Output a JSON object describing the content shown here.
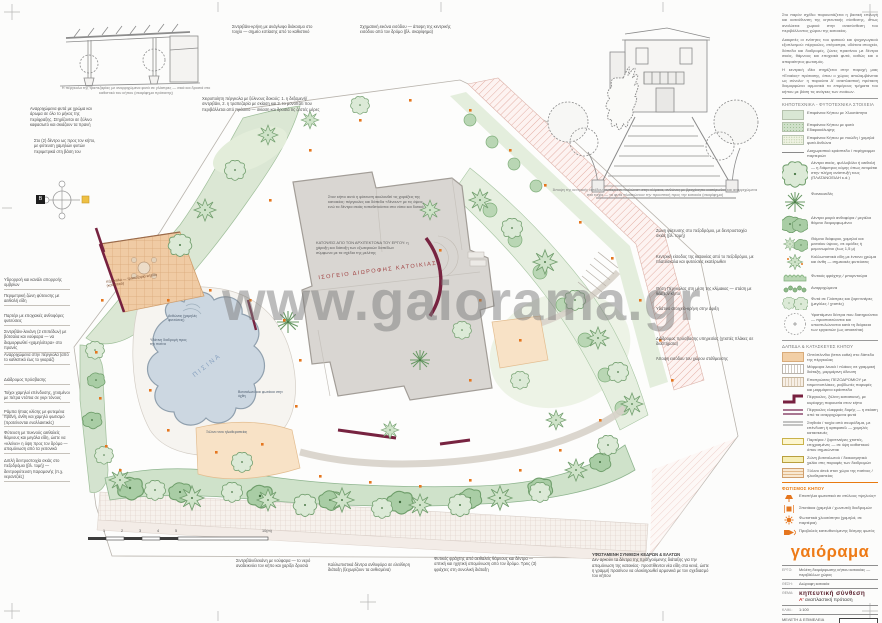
{
  "watermark": "www.gaiorama.gr",
  "compass": {
    "north": "Β"
  },
  "scalebar": {
    "ticks": [
      "1",
      "2",
      "3",
      "4",
      "5"
    ],
    "end_label": "10(m)"
  },
  "sketches": {
    "pergola_caption": "Η πέργκολα της τραπεζαρίας με αναρριχώμενα φυτά σε γλάστρες — σκιά και δροσιά στο καθιστικό του κήπου (σκαρίφημα πρότασης)",
    "house_caption": "Άποψη της κεντρικής εισόδου: κυπαρίσσι-«κολώνα» στην κλίμακα, ανθώνες με βραχόκηπο εκατέρωθεν και αναρριχώμενα στα τοιχία — τα φυτά πλαισιώνουν την προοπτική προς την κατοικία (σκαρίφημα)"
  },
  "plan": {
    "building_label": "ΙΣΟΓΕΙΟ ΔΙΩΡΟΦΗΣ ΚΑΤΟΙΚΙΑΣ",
    "pool_label": "ΠΙΣΙΝΑ",
    "pergola_label": "πέργκολα — τραπεζαρία κήπου (καθιστικό)",
    "note_design": "Στον κήπο αυτό η φύτευση ακολουθεί τις χαράξεις της κατοικίας: πέργκολες και δάπεδα «δένουν» με τις όψεις, ενώ τα δέντρα σκιάς τοποθετούνται στα νότια και δυτικά",
    "note_architect": "ΚΑΤΟΨΕΙΣ ΑΠΟ ΤΟΝ ΑΡΧΙΤΕΚΤΟΝΑ ΤΟΥ ΕΡΓΟΥ: η χάραξη και διάταξη των εξωτερικών δαπέδων σύμφωνα με τα σχέδια της μελέτης",
    "pool_notes": [
      "Ανθώνας (χαμηλές φυτεύσεις)",
      "Υδάτινη διαδρομή προς την πισίνα",
      "Βοτσαλωτό και φωτάκια στην όχθη",
      "Ξύλινο ντεκ ηλιοθεραπείας"
    ]
  },
  "annotations": {
    "left": [
      "Αναρριχώμενα φυτά με χρώμα και άρωμα σε όλο το μήκος της περίφραξης. Στηρίζονται σε ξύλινο καφασωτό και σκιάζουν τα πρανή",
      "Στο (2) δέντρο ως προς τον κήπο, με φύτευση χαμηλών φυτών περιμετρικά στη βάση του",
      "Υδρορροή και κανάλι απορροής ομβρίων",
      "Περιμετρική ζώνη φύτευσης με αειθαλή είδη",
      "Παρτέρι με εποχιακές ανθοφόρες φυτεύσεις",
      "Σιντριβάνι-λεκάνη (2 επιπέδων) με βότσαλα και νούφαρα — να διαμορφωθεί «χαμηλότερα» στο πρανές",
      "Αναρριχώμενα στην πέργκολα (από το καθιστικό έως το γκαράζ)",
      "Διάδρομος πρόσβασης",
      "Τοίχοι χαμηλοί επένδυσης, χτισμένοι με πέτρα ντόπια σε γκρι τόνους",
      "Ράμπα ήπιας κλίσης με φυτεμένα πρανή, άνθη και χαμηλό φωτισμό (προτείνονται εναλλακτικές)",
      "Φύτευση με πυκνούς αειθαλείς θάμνους και μεγάλα είδη, ώστε να «κλείνει» η όψη προς τον δρόμο — απομόνωση από τα γειτονικά",
      "Διπλή δεντροστοιχία σκιάς στο πεζοδρόμιο (βλ. τομή) — δεντροφύτευση παραμονής (π.χ. νεραντζιές)"
    ],
    "top": [
      "Σιντριβάνι-κρήνη με ανάγλυφο διάκοσμο στο τοιχίο — σημείο εστίασης από το καθιστικό",
      "Σχηματική εικόνα εισόδου — άποψη της κεντρικής εισόδου από τον δρόμο (βλ. σκαρίφημα)",
      "Χειροποίητη πέργκολα με ξύλινους δοκούς: 1. η δεξαμενή/σιντριβάνι, 2. η τραπεζαρία με σκίαση και 3. το μονοπάτι που περιβάλλεται από πράσινο — σκίαση και δροσιά τις ζεστές μέρες"
    ],
    "right": [
      "Ζώνη φύτευσης στο πεζοδρόμιο, με δεντροστοιχία σκιάς (βλ. τομή)",
      "Κεντρική είσοδος της κατοικίας από το πεζοδρόμιο, με πλατύσκαλα και φυτεύσεις εκατέρωθεν",
      "Θέση Πέργκολας στη μέση της κλίμακας — στάση με θέα τον κήπο",
      "Υδάτινο στοιχείο-κρήνη στην άφιξη",
      "Διάδρομος πρόσβασης υπηρεσίας (χτιστές πλάκες σε διαστήματα)",
      "Άποψη εισόδου του χώρου στάθμευσης"
    ],
    "bottom": [
      "Σιντριβάνι/λεκάνη με νούφαρα — το νερό αναδεικνύει τον κήπο και χαρίζει δροσιά",
      "Καλλωπιστικά δέντρα ανθοφόρα σε ελεύθερη διάταξη (ξεχωρίζουν τα ανθισμένα)",
      "Φυτικός φράχτης από αειθαλείς θάμνους και δέντρα — οπτική και ηχητική απομόνωση από τον δρόμο. Τρεις (3) φράχτες στη συνολική διάταξη",
      "Δεν αρκούν τα δέντρα της προηγούμενης διάταξης για την απομόνωση της κατοικίας· προστίθενται νέα είδη στα κενά, ώστε η γραμμή πρασίνου να ολοκληρωθεί αρμονικά με τον σχεδιασμό του κήπου"
    ],
    "bottom_header": "ΥΦΙΣΤΑΜΕΝΗ ΣΥΝΘΕΣΗ ΚΕΔΡΩΝ & ΕΛΑΤΩΝ"
  },
  "sidebar": {
    "intro": [
      "Στο παρόν σχέδιο παρουσιάζεται η βασική επιλογή και κατεύθυνση της κηπευτικής σύνθεσης, όπως αναλύεται χωρικά στην ανασύνθεση του περιβάλλοντος χώρου της κατοικίας.",
      "Διακριτές οι ενότητες του φυτικού και ψυχαγωγικού εξοπλισμού: πέργκολες, στέγαστρα, υδάτινα στοιχεία, δάπεδα και διαδρομές, ζώνες πρασίνου με δέντρα σκιάς, θάμνους και εποχιακά φυτά, καθώς και ο απαραίτητος φωτισμός.",
      "Η κεντρική ιδέα στηρίζεται στην παροχή μιας «Ενιαίας» πρότασης, όπου ο χώρος απολαμβάνεται ως σύνολο· η παρούσα Α' αναπλαστική πρόταση διαμορφώνει αρμονικά τα επιμέρους τμήματα του κήπου με βάση τις ανάγκες των ενοίκων."
    ],
    "planting_header": "ΚΗΠΟΤΕΧΝΙΚΑ - ΦΥΤΟΤΕΧΝΙΚΑ ΣΤΟΙΧΕΙΑ",
    "surfaces": [
      "Επιφάνεια Κήπου με Χλοοτάπητα",
      "Επιφάνεια Κήπου με φυτά Εδαφοκάλυψης",
      "Επιφάνεια Κήπου με ποώδη / χαμηλά φυτά Ανθώνα",
      "Διαχωριστικό κράσπεδο / περίγραμμα παρτεριών"
    ],
    "plants": [
      "Δέντρα σκιάς, φυλλοβόλα ή αειθαλή — η διάμετρος κόμης όπως εκτιμάται στην πλήρη ανάπτυξή τους (ΠΛΑΤΑΝΟΕΙΔΗ κ.ά.)",
      "Φοινικοειδές",
      "Δέντρα μικρά ανθοφόρα / μεγάλοι θάμνοι διαμορφωμένοι",
      "Θάμνοι διάφοροι, χαμηλοί και μεσαίου ύψους, σε ομάδες ή μεμονωμένοι (έως 1,5 μ)",
      "Καλλωπιστικά είδη με έντονο χρώμα και άνθη — σημειακές φυτεύσεις",
      "Φυτικός φράχτης / μπορντούρα",
      "Αναρριχώμενα",
      "Φυτά σε Γλάστρες και ζαρντινιέρες (μεγάλες / χτιστές)",
      "Υφιστάμενα δέντρα που διατηρούνται — προστατεύονται και υποστυλώνονται κατά τη διάρκεια των εργασιών (ως απαιτείται)"
    ],
    "hardscape_header": "ΔΑΠΕΔΑ & ΚΑΤΑΣΚΕΥΕΣ ΚΗΠΟΥ",
    "hardscape": [
      "Οπτόπλινθοι (terra cotta) στο δάπεδο της πέργκολας",
      "Μάρμαρα λευκά / πλάκες σε γραμμική διάταξη, μαρμάρινη όδευση",
      "Επιστρώσεις ΠΕΖΟΔΡΟΜΙΟΥ με τσιμεντοπλάκες, ραβδωτές παρυφές και μαρμάρινα κράσπεδα",
      "Πέργκολες, ξύλινη κατασκευή, με κυρίαρχη παρουσία στον κήπο",
      "Πέργκολες ελαφριάς δομής — η σκίαση από τα αναρριχώμενα φυτά",
      "Στηθαία / τοιχία από σκυρόδεμα, με επένδυση ή αρτιφισιέλ — χαμηλές κατασκευές",
      "Παρτέρια / ζαρντινιέρες χτιστές, επιχρισμένες — σε ύψη καθιστικού όπου σημειώνεται",
      "Ζώνη βοτσαλωτού / διακοσμητικό χαλίκι στις παρυφές των διαδρομών",
      "Ξύλινο deck στον χώρο της πισίνας / ηλιοθεραπείας"
    ],
    "lighting_header": "ΦΩΤΙΣΜΟΣ ΚΗΠΟΥ",
    "lighting": [
      "Επιστήλια φωτιστικά σε στύλους «ψηλούς»",
      "Σποτάκια (χαμηλά / χωνευτά) διαδρομών",
      "Φωτιστικά χλοοτάπητα (χαμηλά, σε παρτέρια)",
      "Προβολείς κατευθυνόμενης δέσμης φωτός"
    ],
    "logo": "γαιόραμα",
    "titleblock": {
      "project_label": "ΕΡΓΟ:",
      "project": "Μελέτη διαμόρφωσης κήπου κατοικίας — περιβάλλων χώρος",
      "location_label": "ΘΕΣΗ:",
      "location": "Διώροφη κατοικία",
      "subject_label": "ΘΕΜΑ:",
      "subject_main": "κηπευτική σύνθεση",
      "subject_sub_accent": "Α'",
      "subject_sub": " αναπλαστική πρόταση",
      "scale_label": "ΚΛΙΜ.:",
      "scale": "1:100",
      "credits": "ΜΕΛΕΤΗ & ΕΠΙΜΕΛΕΙΑ ΣΧΕΔΙΟΥ: ΓΑΙΟΡΑΜΑ — αρχιτεκτονική κήπου & κατασκευές",
      "sheet": "L 03a"
    }
  }
}
